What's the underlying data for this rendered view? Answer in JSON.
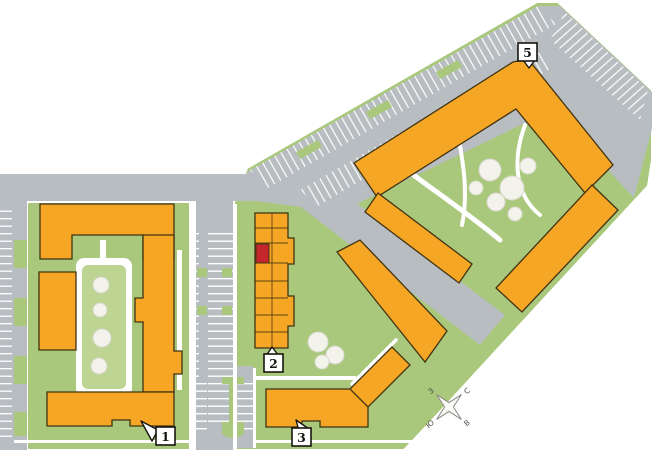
{
  "map": {
    "markers": [
      {
        "id": "building-1",
        "label": "1"
      },
      {
        "id": "building-2",
        "label": "2"
      },
      {
        "id": "building-3",
        "label": "3"
      },
      {
        "id": "building-5",
        "label": "5"
      }
    ],
    "highlighted_unit": {
      "building_label": "2"
    },
    "compass": {
      "north": "С",
      "east": "В",
      "south": "Ю",
      "west": "З"
    },
    "colors": {
      "building": "#F6A625",
      "building_outline": "#403312",
      "highlight": "#C4272B",
      "green": "#A9C87C",
      "courtyard": "#BDD492",
      "tree": "#F3F3EC",
      "road": "#B8BDC1",
      "path": "#FFFFFF"
    }
  }
}
